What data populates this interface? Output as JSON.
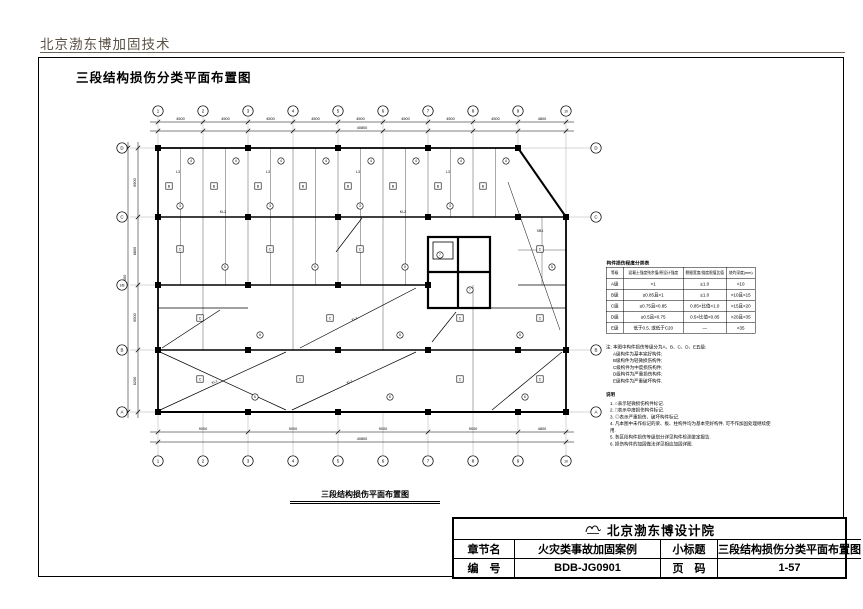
{
  "page": {
    "header": "北京渤东博加固技术",
    "sheet_title": "三段结构损伤分类平面布置图",
    "plan_caption": "三段结构损伤平面布置图"
  },
  "damage_table": {
    "title": "构件损伤程度分类表",
    "headers": [
      "等级",
      "混凝土强度残余值/原设计强度",
      "裂缝宽度/挠度限值比值",
      "烧灼深度(mm)"
    ],
    "rows": [
      [
        "A级",
        ">1",
        "≥1.0",
        "<10"
      ],
      [
        "B级",
        "≥0.85且<1",
        "≥1.0",
        ">10且<15"
      ],
      [
        "C级",
        "≥0.75且<0.85",
        "0.85<比值<1.0",
        ">15且<20"
      ],
      [
        "D级",
        "≥0.5且<0.75",
        "0.5<比值<0.85",
        ">20且<35"
      ],
      [
        "E级",
        "低于0.5, 或低于C20",
        "—",
        ">35"
      ]
    ]
  },
  "notes": {
    "note_lines": [
      "注: 本图中构件损伤等级分为A、B、C、D、E五级:",
      "A级构件为基本完好构件;",
      "B级构件为轻微损伤构件;",
      "C级构件为中度损伤构件;",
      "D级构件为严重损伤构件;",
      "E级构件为严重破坏构件."
    ],
    "legend_title": "说明",
    "legend_items": [
      "1. ○表示轻微损伤构件标记.",
      "2. □表示中度损伤构件标记.",
      "3. ◎表示严重损伤、破坏构件标记.",
      "4. 凡本图中未作标记的梁、板、柱构件均为基本完好构件, 可不作加固处理继续使用.",
      "5. 各区段构件损伤等级划分详见构件检测鉴定报告.",
      "6. 损伤构件的加固做法详见相应加固详图."
    ]
  },
  "title_block": {
    "company": "北京渤东博设计院",
    "chapter_label": "章节名",
    "chapter_value": "火灾类事故加固案例",
    "subtitle_label": "小标题",
    "subtitle_value": "三段结构损伤分类平面布置图",
    "number_label": "编　号",
    "number_value": "BDB-JG0901",
    "page_label": "页　码",
    "page_value": "1-57"
  },
  "plan": {
    "axis_top": [
      "1",
      "2",
      "3",
      "4",
      "5",
      "6",
      "7",
      "8",
      "9",
      "10"
    ],
    "axis_bottom": [
      "1",
      "2",
      "3",
      "4",
      "5",
      "6",
      "7",
      "8",
      "9",
      "10"
    ],
    "axis_left": [
      "D",
      "C",
      "1/B",
      "B",
      "A"
    ],
    "axis_right": [
      "D",
      "C",
      "B",
      "A"
    ],
    "dims_top": [
      "4500",
      "4500",
      "4500",
      "4500",
      "4500",
      "4500",
      "4500",
      "4500",
      "4800"
    ],
    "top_total": "40800",
    "dims_bottom": [
      "9000",
      "9000",
      "9000",
      "9000",
      "4800"
    ],
    "bottom_total": "40800",
    "dims_left": [
      "6900",
      "6800",
      "6500",
      "6200"
    ],
    "left_total": "26400",
    "beam_labels": [
      {
        "x": 178,
        "y": 173,
        "t": "L3"
      },
      {
        "x": 268,
        "y": 173,
        "t": "L3"
      },
      {
        "x": 358,
        "y": 173,
        "t": "L3"
      },
      {
        "x": 448,
        "y": 173,
        "t": "L3"
      },
      {
        "x": 223,
        "y": 213,
        "t": "KL2"
      },
      {
        "x": 403,
        "y": 213,
        "t": "KL2"
      },
      {
        "x": 540,
        "y": 232,
        "t": "XB1"
      }
    ],
    "diag_labels": [
      {
        "x": 215,
        "y": 383,
        "t": "XL1",
        "r": -25
      },
      {
        "x": 350,
        "y": 383,
        "t": "XL1",
        "r": -25
      },
      {
        "x": 355,
        "y": 320,
        "t": "XL1",
        "r": -27
      }
    ],
    "markers": [
      {
        "k": "b",
        "x": 169,
        "y": 186,
        "t": "B"
      },
      {
        "k": "b",
        "x": 214,
        "y": 186,
        "t": "B"
      },
      {
        "k": "b",
        "x": 258,
        "y": 186,
        "t": "B"
      },
      {
        "k": "b",
        "x": 303,
        "y": 186,
        "t": "B"
      },
      {
        "k": "b",
        "x": 348,
        "y": 186,
        "t": "B"
      },
      {
        "k": "b",
        "x": 393,
        "y": 186,
        "t": "B"
      },
      {
        "k": "b",
        "x": 438,
        "y": 186,
        "t": "B"
      },
      {
        "k": "b",
        "x": 483,
        "y": 186,
        "t": "B"
      },
      {
        "k": "c",
        "x": 191,
        "y": 161,
        "t": "4"
      },
      {
        "k": "c",
        "x": 236,
        "y": 161,
        "t": "4"
      },
      {
        "k": "c",
        "x": 281,
        "y": 161,
        "t": "4"
      },
      {
        "k": "c",
        "x": 326,
        "y": 161,
        "t": "4"
      },
      {
        "k": "c",
        "x": 371,
        "y": 161,
        "t": "4"
      },
      {
        "k": "c",
        "x": 416,
        "y": 161,
        "t": "4"
      },
      {
        "k": "c",
        "x": 461,
        "y": 161,
        "t": "4"
      },
      {
        "k": "c",
        "x": 506,
        "y": 161,
        "t": "4"
      },
      {
        "k": "c",
        "x": 180,
        "y": 206,
        "t": "3"
      },
      {
        "k": "c",
        "x": 270,
        "y": 206,
        "t": "3"
      },
      {
        "k": "c",
        "x": 360,
        "y": 206,
        "t": "3"
      },
      {
        "k": "c",
        "x": 450,
        "y": 206,
        "t": "3"
      },
      {
        "k": "b",
        "x": 180,
        "y": 249,
        "t": "C"
      },
      {
        "k": "b",
        "x": 270,
        "y": 249,
        "t": "C"
      },
      {
        "k": "b",
        "x": 360,
        "y": 249,
        "t": "C"
      },
      {
        "k": "c",
        "x": 225,
        "y": 267,
        "t": "5"
      },
      {
        "k": "c",
        "x": 315,
        "y": 267,
        "t": "5"
      },
      {
        "k": "c",
        "x": 405,
        "y": 267,
        "t": "5"
      },
      {
        "k": "b",
        "x": 540,
        "y": 249,
        "t": "C"
      },
      {
        "k": "c",
        "x": 552,
        "y": 267,
        "t": "5"
      },
      {
        "k": "b",
        "x": 200,
        "y": 318,
        "t": "C"
      },
      {
        "k": "b",
        "x": 330,
        "y": 318,
        "t": "C"
      },
      {
        "k": "b",
        "x": 460,
        "y": 318,
        "t": "C"
      },
      {
        "k": "b",
        "x": 540,
        "y": 318,
        "t": "C"
      },
      {
        "k": "c",
        "x": 260,
        "y": 335,
        "t": "6"
      },
      {
        "k": "c",
        "x": 400,
        "y": 335,
        "t": "6"
      },
      {
        "k": "c",
        "x": 520,
        "y": 335,
        "t": "6"
      },
      {
        "k": "b",
        "x": 200,
        "y": 379,
        "t": "C"
      },
      {
        "k": "b",
        "x": 300,
        "y": 379,
        "t": "C"
      },
      {
        "k": "b",
        "x": 460,
        "y": 379,
        "t": "C"
      },
      {
        "k": "b",
        "x": 540,
        "y": 379,
        "t": "C"
      },
      {
        "k": "c",
        "x": 255,
        "y": 397,
        "t": "6"
      },
      {
        "k": "c",
        "x": 390,
        "y": 397,
        "t": "6"
      },
      {
        "k": "c",
        "x": 525,
        "y": 397,
        "t": "6"
      },
      {
        "k": "c",
        "x": 440,
        "y": 255,
        "t": "7"
      },
      {
        "k": "c",
        "x": 470,
        "y": 290,
        "t": "7"
      }
    ]
  }
}
